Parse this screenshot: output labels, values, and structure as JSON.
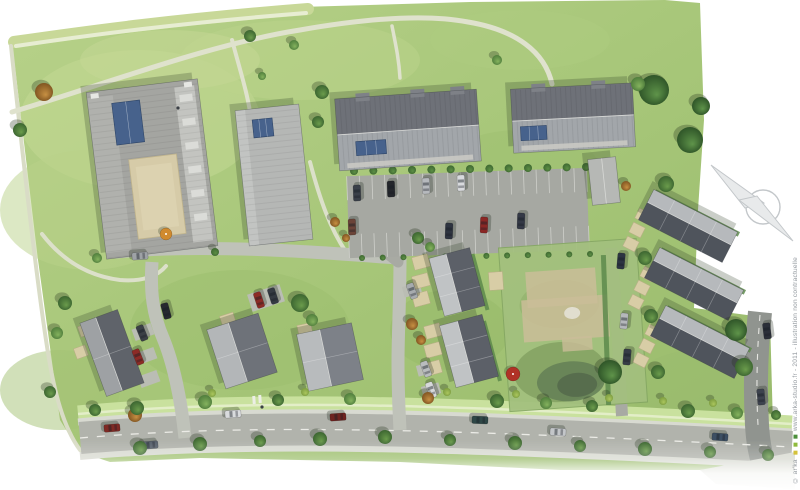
{
  "watermark": {
    "prefix": "© ar'ka",
    "rest": "www.arka-studio.fr - 2011 - illustration non contractuelle",
    "squares": [
      "#d4c23a",
      "#8fba3c",
      "#4c8f3b"
    ],
    "color": "#959ba1"
  },
  "compass": {
    "label": "N",
    "circle": [
      763,
      207,
      17
    ],
    "darts": [
      "711,165 764,203 745,208",
      "793,241 739,200 757,196"
    ],
    "stroke": "#c3c7ca",
    "fill": "#e8eaeb"
  },
  "palette": {
    "background": "#ffffff",
    "grass_gradient": [
      "#b7d189",
      "#a5c577",
      "#98ba6b"
    ],
    "main_road": "#b1b3ac",
    "internal_road": "#bfc2b9",
    "dark_road": "#90948f",
    "sidewalk": "#d8dad1",
    "verge_green": "#c9e19e",
    "roof_light": "#c0c3c5",
    "roof_dark": "#565b63",
    "skylight_blue": "#47628c",
    "courtyard_beige": "#d6cba8",
    "patio_beige": "#d8cda6",
    "hedge_green": "#5d8a4b",
    "trees": {
      "g": [
        "#6b9c4c",
        "#39622f"
      ],
      "m": [
        "#85b35e",
        "#4c7a3a"
      ],
      "b": [
        "#5f944a",
        "#2c5126"
      ],
      "o": [
        "#c79043",
        "#7c511f"
      ],
      "s": [
        "#5d8f45",
        "#3c6630"
      ],
      "s2": [
        "#abc75e",
        "#7a9a3e"
      ]
    }
  },
  "scene": {
    "site": {
      "points": "12,42 150,23 300,7 470,2 665,0 700,3 704,120 698,210 694,308 770,318 774,462 700,470 560,470 400,462 200,458 110,462 80,452 60,420 38,260"
    },
    "grass_patches": [
      [
        140,
        120,
        120,
        70,
        "#c3d893",
        0.55
      ],
      [
        90,
        210,
        90,
        60,
        "#b9d189",
        0.5
      ],
      [
        300,
        60,
        120,
        40,
        "#bcd48c",
        0.5
      ],
      [
        520,
        40,
        90,
        30,
        "#aecb7f",
        0.5
      ],
      [
        240,
        330,
        110,
        60,
        "#9cbd6e",
        0.5
      ],
      [
        520,
        170,
        80,
        40,
        "#9cbd6e",
        0.4
      ],
      [
        60,
        390,
        60,
        40,
        "#a3c274",
        0.5
      ],
      [
        450,
        330,
        60,
        40,
        "#95b768",
        0.45
      ],
      [
        700,
        390,
        70,
        40,
        "#9abc6d",
        0.5
      ],
      [
        170,
        60,
        90,
        30,
        "#c6d896",
        0.5
      ]
    ],
    "meadow": [
      {
        "d": "M 14,42 C 90,31 180,19 308,9",
        "w": 12,
        "c": "#c8d898"
      },
      {
        "d": "M 16,46 C 90,35 180,23 306,13",
        "w": 4,
        "c": "#e7edd2"
      }
    ],
    "paths": [
      {
        "d": "M 11,46 C 22,150 34,260 46,340 C 54,395 64,428 80,450",
        "w": 4,
        "c": "#d9dcc6"
      },
      {
        "d": "M 12,112 C 100,86 210,44 300,30 C 380,16 432,15 468,22 C 516,30 545,52 552,84",
        "w": 5,
        "c": "#dfe2cd"
      },
      {
        "d": "M 42,234 C 62,260 88,276 120,280 C 142,282 158,276 166,266",
        "w": 4,
        "c": "#dce0ca"
      },
      {
        "d": "M 232,40 C 240,70 247,92 250,112",
        "w": 4,
        "c": "#dfe2cd"
      },
      {
        "d": "M 310,162 C 320,200 330,228 346,252",
        "w": 4,
        "c": "#dce0ca"
      },
      {
        "d": "M 392,26 C 396,46 399,60 400,78",
        "w": 3.5,
        "c": "#dfe2cd"
      }
    ],
    "roads": [
      {
        "d": "M 78,414 C 250,398 450,404 792,424",
        "w": 17,
        "c": "#c9e19e"
      },
      {
        "d": "M 78,414 C 250,398 450,404 792,424",
        "w": 2.5,
        "c": "#e3eec8"
      },
      {
        "d": "M 78,422 C 250,406 450,412 792,432",
        "w": 7,
        "c": "#d8dad1"
      },
      {
        "d": "M 80,456 C 250,441 450,447 792,465",
        "w": 8,
        "c": "#d8dad1"
      },
      {
        "d": "M 80,438 C 250,423 450,429 792,447",
        "w": 32,
        "c": "#b1b3ac"
      },
      {
        "d": "M 757,446 L 784,480",
        "w": 26,
        "c": "#b1b3ac"
      },
      {
        "d": "M 116,252 C 180,246 260,249 310,252 C 345,254 370,256 396,258",
        "w": 13,
        "c": "#bfc2b9",
        "cap": "round"
      },
      {
        "d": "M 152,262 C 150,292 153,315 163,338 C 173,362 181,398 185,438",
        "w": 13,
        "c": "#bfc2b9"
      },
      {
        "d": "M 400,258 C 400,300 398,335 398,362 C 398,395 399,412 400,430",
        "w": 13,
        "c": "#bfc2b9"
      },
      {
        "d": "M 398,262 C 384,250 370,241 354,235",
        "w": 11,
        "c": "#a8aaa3",
        "cap": "round"
      },
      {
        "d": "M 611,248 C 614,282 616,312 618,342 C 620,376 621,396 622,416",
        "w": 12,
        "c": "#a8aaa3"
      },
      {
        "d": "M 760,312 C 756,350 755,390 757,425 C 758,442 760,452 764,466",
        "w": 24,
        "c": "#90948f"
      }
    ],
    "dashes": [
      {
        "d": "M 80,438 C 250,423 450,429 792,447",
        "w": 1.3,
        "c": "#ebebe6",
        "dash": "8 9"
      },
      {
        "d": "M 760,315 C 757,350 756,390 758,425",
        "w": 1.1,
        "c": "#e6e6e2",
        "dash": "6 7"
      }
    ],
    "wedges": [
      {
        "points": "700,470 795,452 795,489 716,484",
        "c": "#d8dad1"
      }
    ],
    "crossing": [
      [
        254,
        400
      ],
      [
        260,
        399
      ]
    ],
    "parking": {
      "cx": 468,
      "cy": 213,
      "w": 240,
      "h": 82,
      "rot": -2,
      "c": "#a6a8a2",
      "bay": 24,
      "slots": 19,
      "line": "#d8d9d4"
    },
    "parcel": {
      "cx": 573,
      "cy": 325,
      "w": 138,
      "h": 164,
      "rot": -4,
      "base": "#a3c07e",
      "edge": "#85a763",
      "beige": "#cabd98",
      "pond": "#647f56",
      "pond2": "#55684b"
    },
    "hedges": [
      [
        697,
        213,
        94,
        5,
        27
      ],
      [
        703,
        271,
        94,
        5,
        27
      ],
      [
        709,
        329,
        94,
        5,
        27
      ],
      [
        606,
        330,
        5,
        150,
        -2
      ],
      [
        480,
        282,
        4,
        58,
        -15
      ],
      [
        492,
        351,
        4,
        62,
        -15
      ]
    ],
    "shrub_rows": [
      [
        354,
        171,
        586,
        167,
        13,
        4
      ],
      [
        362,
        258,
        590,
        254,
        12,
        3
      ]
    ],
    "pads": [
      [
        143,
        332,
        20,
        12,
        -20
      ],
      [
        146,
        356,
        20,
        12,
        -20
      ],
      [
        149,
        379,
        20,
        12,
        -20
      ],
      [
        266,
        298,
        34,
        18,
        -18
      ],
      [
        412,
        290,
        18,
        11,
        -15
      ],
      [
        426,
        369,
        18,
        11,
        -15
      ],
      [
        431,
        390,
        18,
        11,
        -15
      ]
    ],
    "patios": [
      [
        421,
        262,
        16,
        13,
        -15
      ],
      [
        421,
        281,
        16,
        13,
        -15
      ],
      [
        421,
        299,
        16,
        13,
        -15
      ],
      [
        433,
        331,
        16,
        13,
        -15
      ],
      [
        433,
        350,
        16,
        13,
        -15
      ],
      [
        433,
        368,
        16,
        13,
        -15
      ],
      [
        643,
        216,
        13,
        11,
        27
      ],
      [
        637,
        230,
        13,
        11,
        27
      ],
      [
        631,
        244,
        13,
        11,
        27
      ],
      [
        648,
        274,
        13,
        11,
        27
      ],
      [
        642,
        288,
        13,
        11,
        27
      ],
      [
        636,
        302,
        13,
        11,
        27
      ],
      [
        653,
        332,
        13,
        11,
        27
      ],
      [
        647,
        346,
        13,
        11,
        27
      ],
      [
        641,
        360,
        13,
        11,
        27
      ],
      [
        85,
        330,
        12,
        11,
        -20
      ],
      [
        81,
        352,
        12,
        11,
        -20
      ],
      [
        228,
        320,
        14,
        12,
        -18
      ],
      [
        305,
        330,
        14,
        12,
        -12
      ],
      [
        496,
        281,
        14,
        18,
        -4
      ]
    ],
    "buildings": [
      {
        "id": "apartment-block-a",
        "type": "flatA",
        "cx": 152,
        "cy": 169,
        "w": 112,
        "h": 168,
        "rot": -7
      },
      {
        "id": "apartment-block-b",
        "type": "flat",
        "cx": 274,
        "cy": 175,
        "w": 64,
        "h": 136,
        "rot": -6,
        "panel": [
          -16,
          -57,
          20,
          18
        ]
      },
      {
        "id": "apartment-block-c",
        "type": "duo",
        "cx": 408,
        "cy": 130,
        "w": 142,
        "h": 72,
        "rot": -4,
        "panel": [
          -53,
          8,
          30,
          14
        ],
        "chimneys": [
          -43,
          12,
          52
        ]
      },
      {
        "id": "apartment-block-d",
        "type": "duo",
        "cx": 573,
        "cy": 118,
        "w": 122,
        "h": 64,
        "rot": -3,
        "panel": [
          -53,
          6,
          26,
          14
        ],
        "chimneys": [
          -33,
          27
        ]
      },
      {
        "id": "annex-building",
        "type": "garage",
        "cx": 604,
        "cy": 181,
        "w": 28,
        "h": 46,
        "rot": -6
      },
      {
        "id": "rowhouses-center-1",
        "type": "row",
        "cx": 457,
        "cy": 282,
        "w": 42,
        "h": 60,
        "rot": -15,
        "ridge": "v",
        "units": 3,
        "light": "#c0c3c5",
        "dark": "#5c6068"
      },
      {
        "id": "rowhouses-center-2",
        "type": "row",
        "cx": 469,
        "cy": 351,
        "w": 44,
        "h": 64,
        "rot": -15,
        "ridge": "v",
        "units": 3,
        "light": "#c0c3c5",
        "dark": "#5c6068"
      },
      {
        "id": "rowhouses-east-1",
        "type": "row",
        "cx": 688,
        "cy": 226,
        "w": 94,
        "h": 34,
        "rot": 27,
        "ridge": "h",
        "units": 4,
        "light": "#b6b9bc",
        "dark": "#4f545c"
      },
      {
        "id": "rowhouses-east-2",
        "type": "row",
        "cx": 694,
        "cy": 284,
        "w": 94,
        "h": 34,
        "rot": 27,
        "ridge": "h",
        "units": 4,
        "light": "#b6b9bc",
        "dark": "#4f545c"
      },
      {
        "id": "rowhouses-east-3",
        "type": "row",
        "cx": 700,
        "cy": 342,
        "w": 94,
        "h": 34,
        "rot": 27,
        "ridge": "h",
        "units": 4,
        "light": "#b6b9bc",
        "dark": "#4f545c"
      },
      {
        "id": "house-southwest-1",
        "type": "row",
        "cx": 112,
        "cy": 353,
        "w": 40,
        "h": 78,
        "rot": -20,
        "ridge": "v",
        "units": 2,
        "light": "#9ea1a4",
        "dark": "#5f636a"
      },
      {
        "id": "house-southwest-2",
        "type": "row",
        "cx": 242,
        "cy": 351,
        "w": 54,
        "h": 62,
        "rot": -18,
        "ridge": "v",
        "units": 2,
        "light": "#b3b6b8",
        "dark": "#6e7279"
      },
      {
        "id": "house-southwest-3",
        "type": "row",
        "cx": 330,
        "cy": 357,
        "w": 56,
        "h": 58,
        "rot": -12,
        "ridge": "v",
        "units": 2,
        "light": "#b8bbbd",
        "dark": "#7d8188"
      }
    ],
    "trees": [
      [
        44,
        92,
        9,
        "o"
      ],
      [
        20,
        130,
        7,
        "g"
      ],
      [
        250,
        36,
        6,
        "g"
      ],
      [
        294,
        45,
        5,
        "m"
      ],
      [
        322,
        92,
        7,
        "g"
      ],
      [
        318,
        122,
        6,
        "g"
      ],
      [
        262,
        76,
        4,
        "m"
      ],
      [
        654,
        90,
        15,
        "b"
      ],
      [
        690,
        140,
        13,
        "b"
      ],
      [
        701,
        106,
        9,
        "b"
      ],
      [
        666,
        184,
        8,
        "g"
      ],
      [
        638,
        84,
        7,
        "m"
      ],
      [
        626,
        186,
        5,
        "o"
      ],
      [
        645,
        258,
        7,
        "g"
      ],
      [
        651,
        316,
        7,
        "g"
      ],
      [
        658,
        372,
        7,
        "g"
      ],
      [
        610,
        372,
        12,
        "b"
      ],
      [
        736,
        330,
        11,
        "b"
      ],
      [
        744,
        367,
        9,
        "g"
      ],
      [
        300,
        303,
        9,
        "g"
      ],
      [
        312,
        320,
        6,
        "m"
      ],
      [
        418,
        238,
        6,
        "g"
      ],
      [
        430,
        247,
        5,
        "m"
      ],
      [
        412,
        324,
        6,
        "o"
      ],
      [
        421,
        340,
        5,
        "o"
      ],
      [
        335,
        222,
        5,
        "o"
      ],
      [
        346,
        238,
        4,
        "o"
      ],
      [
        65,
        303,
        7,
        "g"
      ],
      [
        57,
        333,
        6,
        "m"
      ],
      [
        50,
        392,
        6,
        "g"
      ],
      [
        135,
        415,
        7,
        "o"
      ],
      [
        95,
        410,
        6,
        "g"
      ],
      [
        97,
        258,
        5,
        "m"
      ],
      [
        215,
        252,
        4,
        "s"
      ],
      [
        497,
        60,
        5,
        "m"
      ],
      [
        137,
        408,
        7,
        "g"
      ],
      [
        205,
        402,
        7,
        "m"
      ],
      [
        278,
        400,
        6,
        "g"
      ],
      [
        350,
        399,
        6,
        "m"
      ],
      [
        428,
        398,
        6,
        "o"
      ],
      [
        497,
        401,
        7,
        "g"
      ],
      [
        546,
        403,
        6,
        "m"
      ],
      [
        592,
        406,
        6,
        "g"
      ],
      [
        688,
        411,
        7,
        "g"
      ],
      [
        737,
        413,
        6,
        "m"
      ],
      [
        776,
        415,
        5,
        "g"
      ],
      [
        212,
        393,
        4,
        "s2"
      ],
      [
        305,
        392,
        4,
        "s2"
      ],
      [
        447,
        392,
        4,
        "s2"
      ],
      [
        516,
        394,
        4,
        "s2"
      ],
      [
        609,
        398,
        4,
        "s2"
      ],
      [
        663,
        401,
        4,
        "s2"
      ],
      [
        713,
        403,
        4,
        "s2"
      ],
      [
        140,
        448,
        7,
        "g"
      ],
      [
        200,
        444,
        7,
        "g"
      ],
      [
        260,
        441,
        6,
        "g"
      ],
      [
        320,
        439,
        7,
        "g"
      ],
      [
        385,
        437,
        7,
        "g"
      ],
      [
        450,
        440,
        6,
        "g"
      ],
      [
        515,
        443,
        7,
        "g"
      ],
      [
        580,
        446,
        6,
        "g"
      ],
      [
        645,
        449,
        7,
        "g"
      ],
      [
        710,
        452,
        6,
        "g"
      ],
      [
        768,
        455,
        6,
        "g"
      ]
    ],
    "cars": [
      [
        112,
        428,
        -5,
        "#7e2a24"
      ],
      [
        150,
        445,
        -5,
        "#57606b"
      ],
      [
        233,
        414,
        -4,
        "#d9dbdd"
      ],
      [
        338,
        417,
        -4,
        "#6e2320"
      ],
      [
        480,
        420,
        2,
        "#2e4746"
      ],
      [
        558,
        432,
        3,
        "#c3c6c9"
      ],
      [
        720,
        437,
        4,
        "#3c4f63"
      ],
      [
        357,
        193,
        88,
        "#3a4049"
      ],
      [
        391,
        189,
        88,
        "#24272c"
      ],
      [
        426,
        186,
        88,
        "#b6b9bd"
      ],
      [
        461,
        183,
        88,
        "#d8dadd"
      ],
      [
        352,
        227,
        88,
        "#6b4438"
      ],
      [
        449,
        231,
        92,
        "#2e3440"
      ],
      [
        484,
        225,
        92,
        "#8a2725"
      ],
      [
        521,
        221,
        92,
        "#343946"
      ],
      [
        621,
        261,
        95,
        "#2c3542"
      ],
      [
        624,
        321,
        95,
        "#b5b8bb"
      ],
      [
        627,
        357,
        95,
        "#363c46"
      ],
      [
        767,
        331,
        83,
        "#2b2f38"
      ],
      [
        761,
        397,
        85,
        "#3d434e"
      ],
      [
        142,
        333,
        68,
        "#3a3f45"
      ],
      [
        138,
        357,
        68,
        "#8c2b26"
      ],
      [
        166,
        311,
        75,
        "#26292f"
      ],
      [
        140,
        256,
        -4,
        "#9ea2a6"
      ],
      [
        259,
        300,
        72,
        "#8c2b26"
      ],
      [
        273,
        296,
        72,
        "#343a42"
      ],
      [
        412,
        291,
        70,
        "#a7abae"
      ],
      [
        426,
        369,
        70,
        "#b9bcbe"
      ],
      [
        431,
        390,
        70,
        "#d7d9db"
      ]
    ],
    "umbrellas": [
      [
        166,
        234,
        6,
        "#d08a2e"
      ],
      [
        513,
        374,
        7,
        "#b03226"
      ]
    ],
    "figures": [
      [
        178,
        108
      ],
      [
        262,
        407
      ]
    ],
    "fade": {
      "y": 440,
      "h": 52
    }
  }
}
